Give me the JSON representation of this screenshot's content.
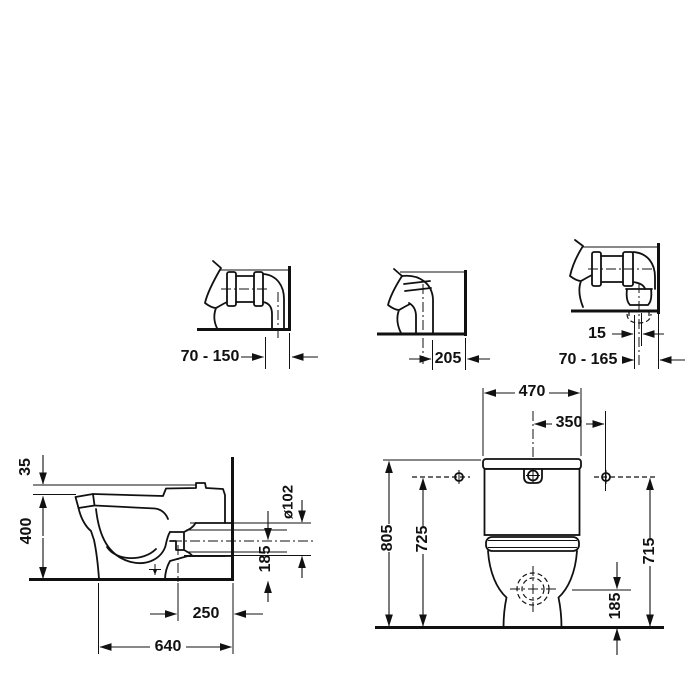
{
  "drawing": {
    "subject": "floor-standing close-coupled WC technical dimension drawing",
    "colors": {
      "line": "#111111",
      "background": "#ffffff"
    },
    "dimensions": {
      "detail1_wall_distance": "70 - 150",
      "detail2_wall_distance": "205",
      "detail3_offset": "15",
      "detail3_wall_distance": "70 - 165",
      "side": {
        "seat_lip": "35",
        "height": "400",
        "outlet_dia": "ø102",
        "outlet_height": "185",
        "outlet_wall": "250",
        "depth": "640"
      },
      "front": {
        "width": "470",
        "holes": "350",
        "total_height": "805",
        "left_height": "725",
        "right_height": "715",
        "outlet_height": "185"
      }
    }
  }
}
